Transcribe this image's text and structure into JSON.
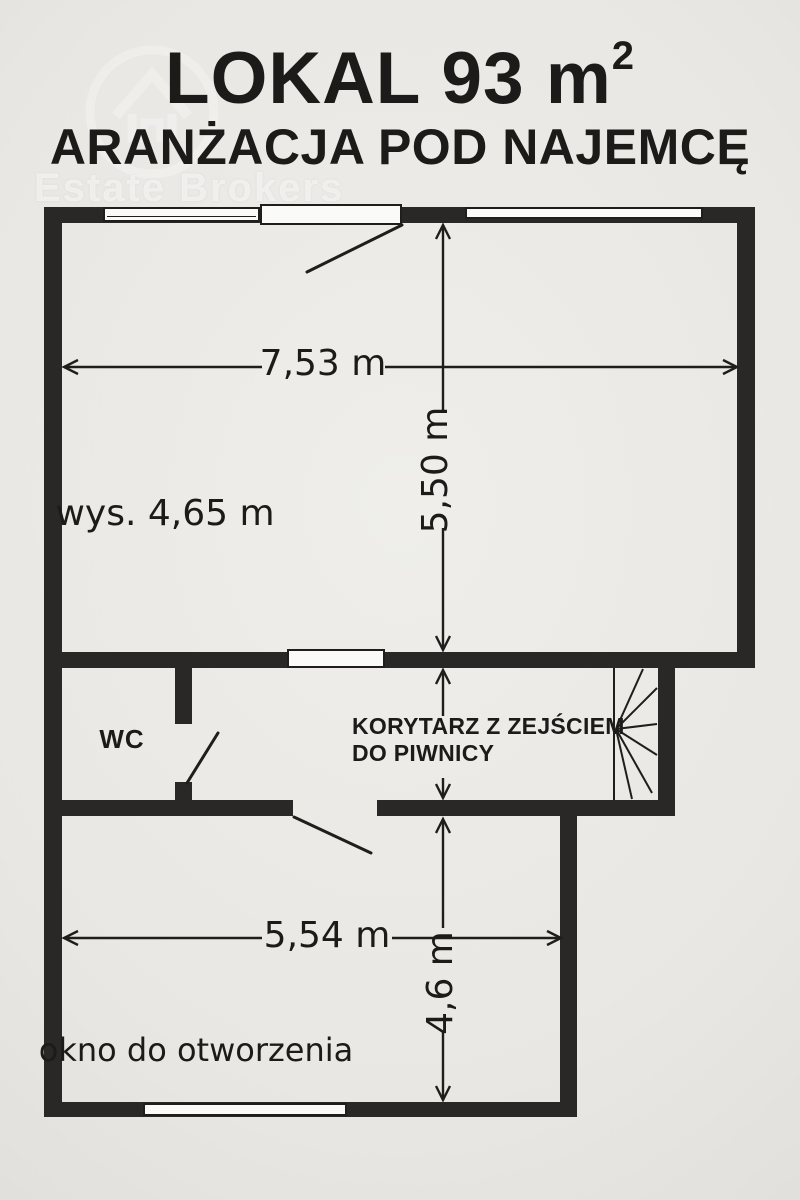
{
  "header": {
    "title": "LOKAL 93 m",
    "title_sup": "2",
    "subtitle": "ARANŻACJA POD NAJEMCĘ"
  },
  "watermark": {
    "brand": "Estate Brokers"
  },
  "plan": {
    "main_room": {
      "width": "7,53 m",
      "depth": "5,50 m",
      "ceiling_height": "wys. 4,65 m"
    },
    "wc": {
      "label": "WC"
    },
    "corridor": {
      "line1": "KORYTARZ Z ZEJŚCIEM",
      "line2": "DO PIWNICY"
    },
    "lower_room": {
      "width": "5,54 m",
      "depth": "4,6 m",
      "window_note": "okno do otworzenia"
    }
  },
  "colors": {
    "background": "#e9e7e3",
    "wall": "#2a2826",
    "line": "#1f1e1c",
    "text": "#1c1b19",
    "window_fill": "#fafaf8"
  }
}
